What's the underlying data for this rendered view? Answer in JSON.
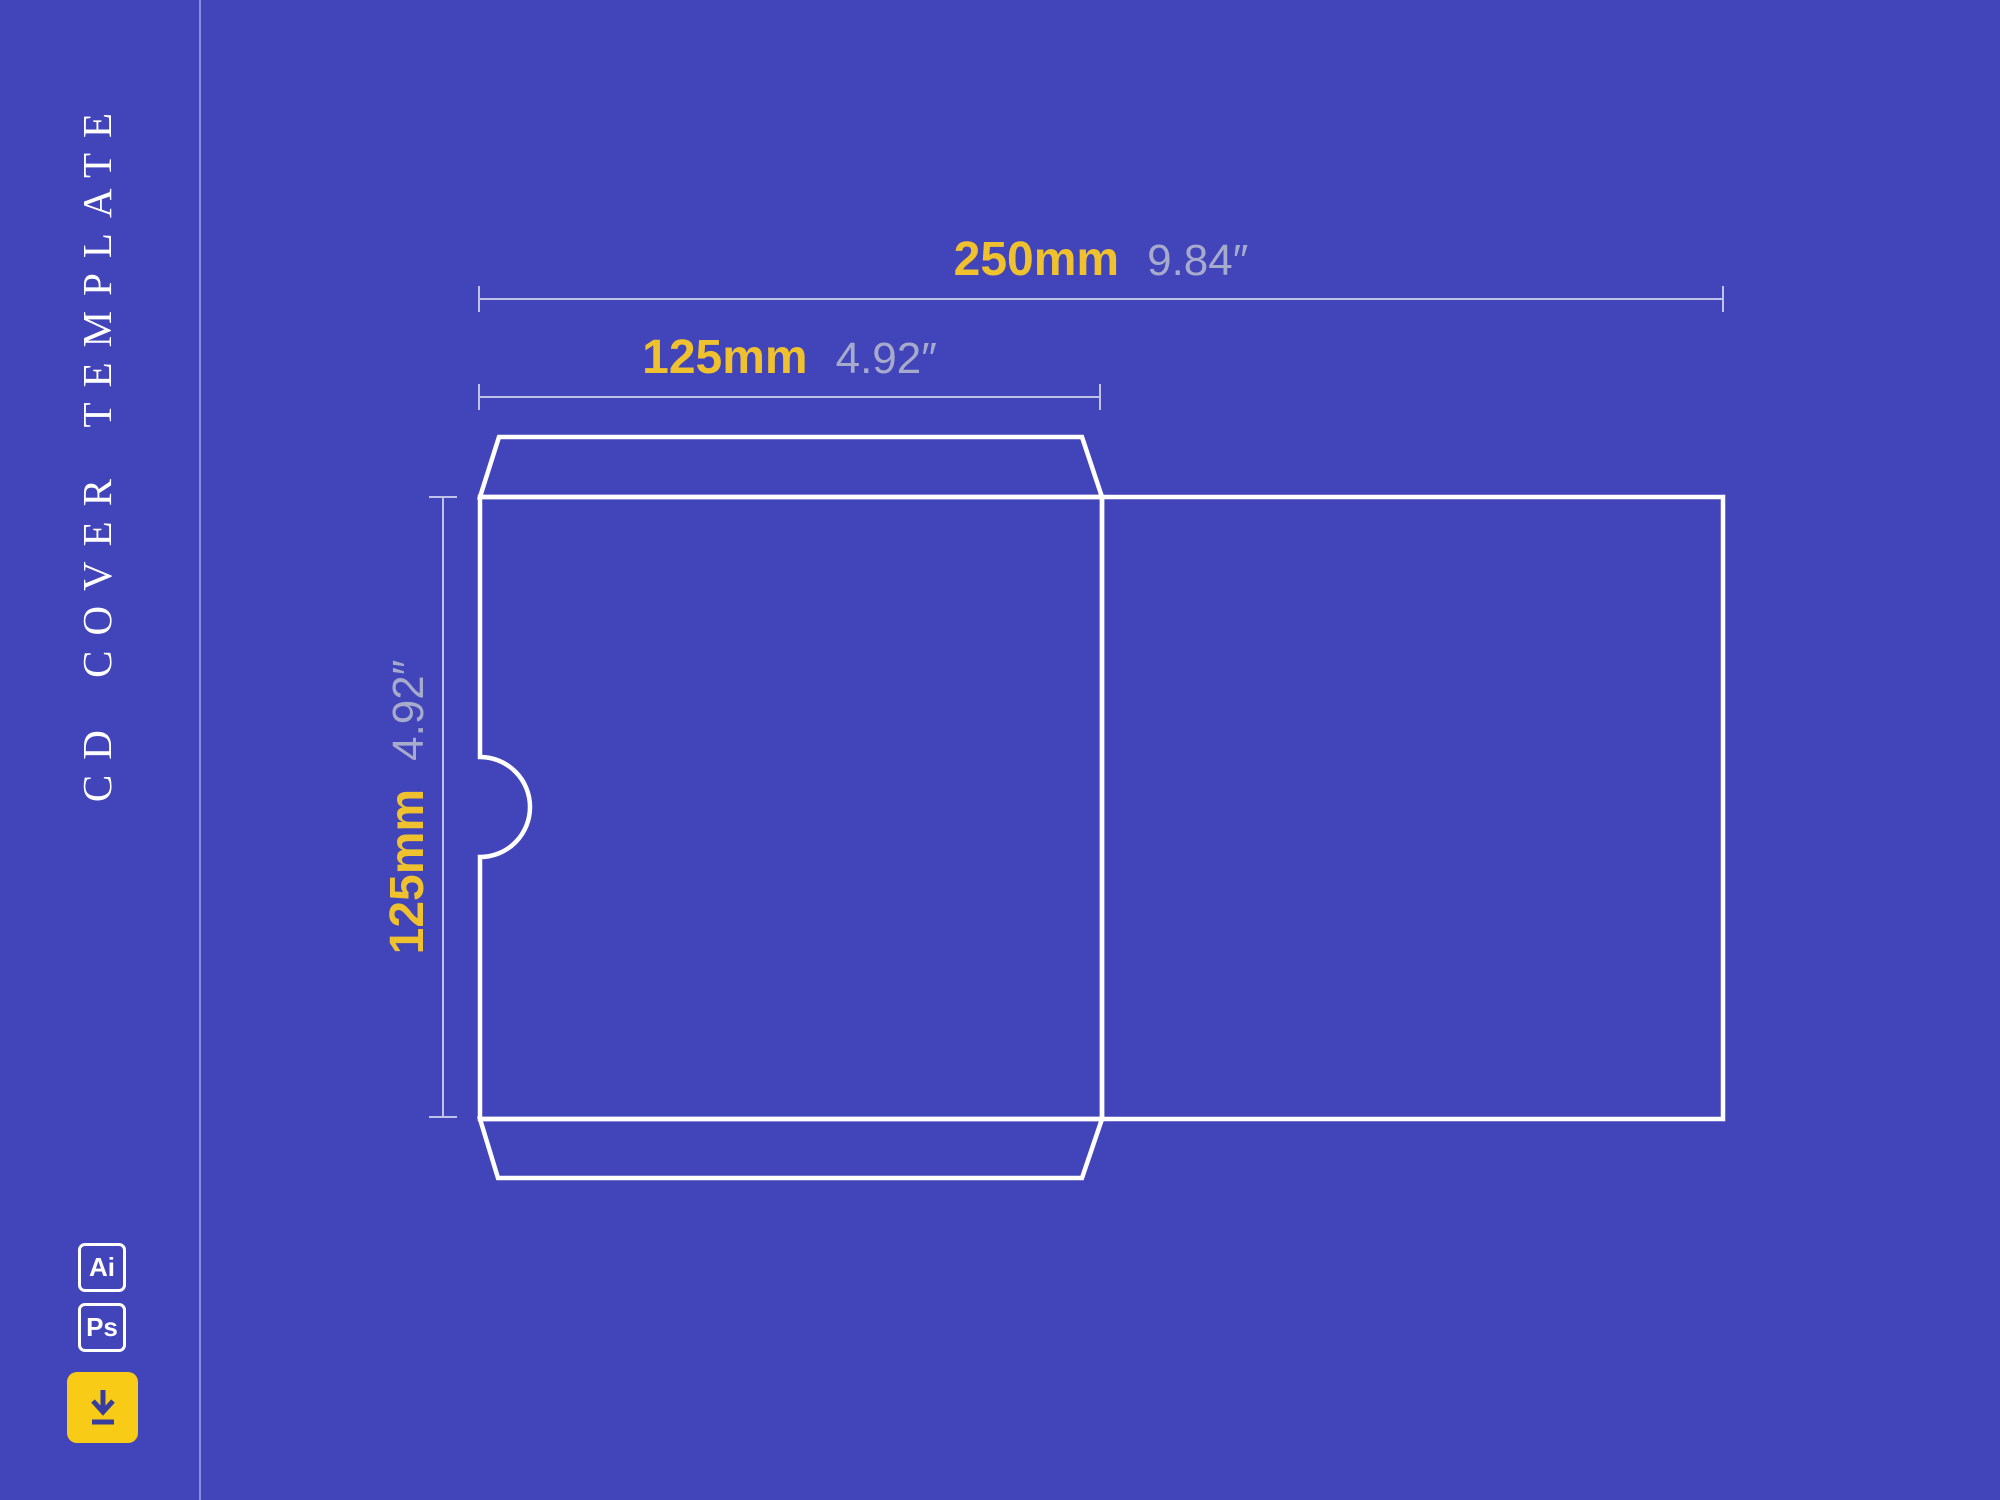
{
  "title": {
    "text": "CD COVER TEMPLATE"
  },
  "dims": {
    "total_width": {
      "value": "250",
      "unit": "mm",
      "imperial": "9.84″"
    },
    "half_width": {
      "value": "125",
      "unit": "mm",
      "imperial": "4.92″"
    },
    "height": {
      "value": "125",
      "unit": "mm",
      "imperial": "4.92″"
    }
  },
  "badges": [
    {
      "label": "Ai"
    },
    {
      "label": "Ps"
    }
  ],
  "download_button": {
    "icon": "download-icon"
  },
  "colors": {
    "background": "#4245BA",
    "metric_text": "#EFC12E",
    "imperial_text": "#A6AACB",
    "dieline": "#FFFFFF",
    "dimension_line": "#CDD0EC",
    "button_yellow": "#F8CB16",
    "icon_blue": "#383C9E"
  }
}
